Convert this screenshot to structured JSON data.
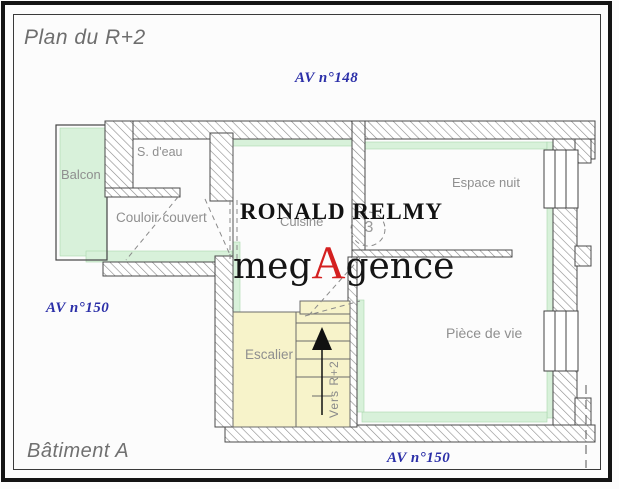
{
  "page": {
    "title": "Plan du R+2",
    "building_label": "Bâtiment A"
  },
  "avenue_labels": {
    "top": "AV n°148",
    "left": "AV n°150",
    "bottom": "AV n°150"
  },
  "room_labels": {
    "balcon": "Balcon",
    "s_deau": "S. d'eau",
    "couloir_couvert": "Couloir couvert",
    "cuisine": "Cuisine",
    "espace_nuit": "Espace nuit",
    "piece_de_vie": "Pièce de vie",
    "escalier": "Escalier",
    "vers_r2": "Vers R+2",
    "circle_number": "3"
  },
  "watermarks": {
    "agent_name": "RONALD RELMY",
    "brand": {
      "prefix": "meg",
      "accent": "A",
      "suffix": "gence"
    }
  },
  "colors": {
    "avenue_blue": "#2b2fa8",
    "brand_red": "#d42020",
    "wall_outline": "#4a4a4a",
    "hatch_gray": "#8a8a8a",
    "room_green": "#d8f1da",
    "stair_yellow": "#f7f3ca",
    "label_gray": "#8f8f8f"
  }
}
